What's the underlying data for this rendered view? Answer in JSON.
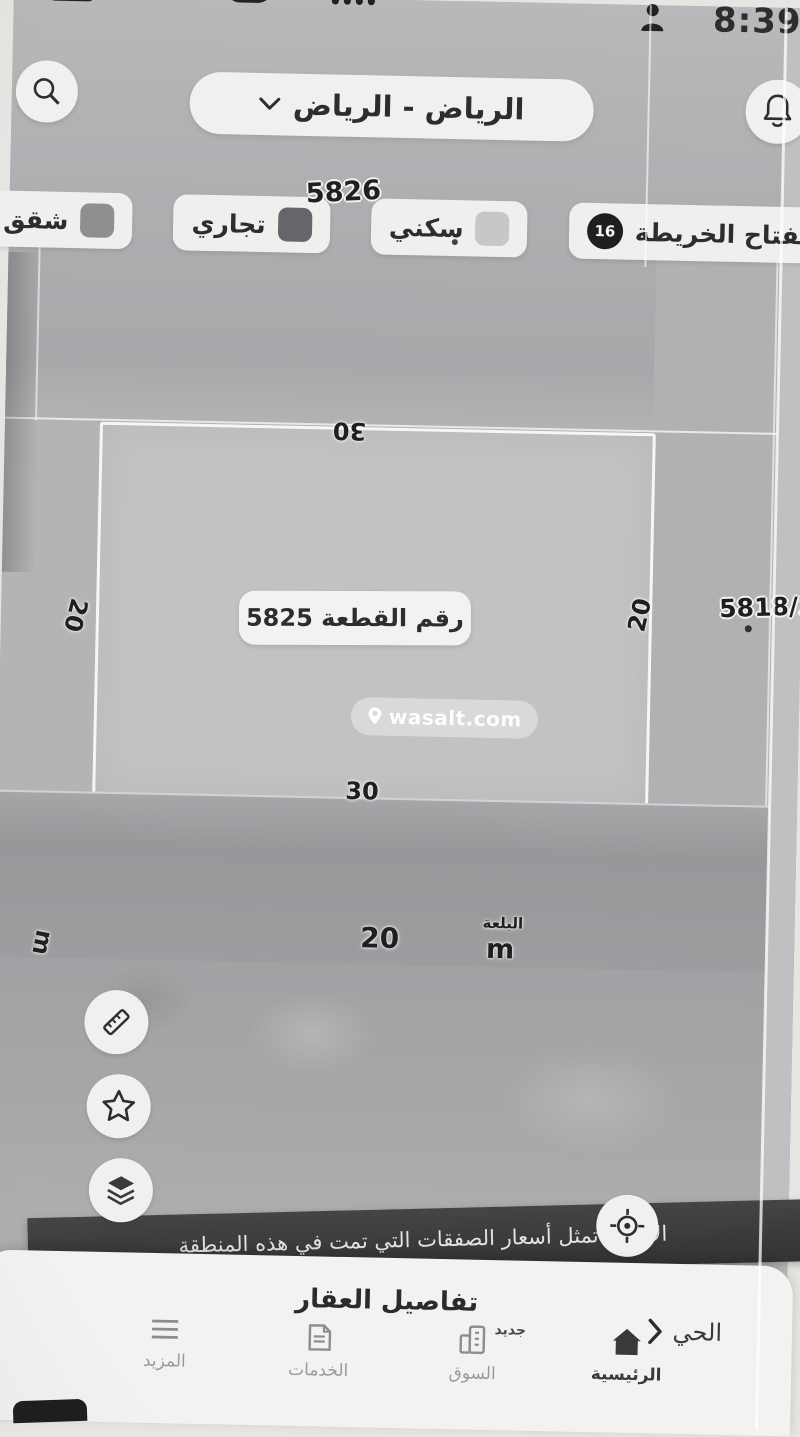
{
  "status_bar": {
    "time": "8:39"
  },
  "header": {
    "location": "الرياض - الرياض"
  },
  "filters": {
    "map_key_label": "مفتاح الخريطة",
    "map_key_badge": "16",
    "chips": [
      {
        "label": "سكني",
        "swatch": "#c7c7c8"
      },
      {
        "label": "تجاري",
        "swatch": "#66666a"
      },
      {
        "label": "شقق",
        "swatch": "#8f8f92"
      }
    ]
  },
  "map": {
    "block_label": "5826",
    "adjacent_parcel_label": "5818/2",
    "parcel": {
      "title": "رقم القطعة 5825",
      "dim_top": "30",
      "dim_bottom": "30",
      "dim_left": "20",
      "dim_right": "20"
    },
    "street": {
      "width": "20",
      "name": "البلعة",
      "unit": "m",
      "left_unit": "m"
    },
    "watermark": "wasalt.com",
    "notice": "الأسعار تمثل أسعار الصفقات التي تمت في هذه المنطقة"
  },
  "sheet": {
    "title": "تفاصيل العقار",
    "district_link": "الحي"
  },
  "bottom_nav": {
    "items": [
      {
        "label": "الرئيسية",
        "icon": "home-icon",
        "active": true
      },
      {
        "label": "السوق",
        "icon": "market-icon",
        "badge": "جديد"
      },
      {
        "label": "الخدمات",
        "icon": "services-document-icon"
      },
      {
        "label": "المزيد",
        "icon": "more-menu-icon"
      }
    ]
  },
  "colors": {
    "map_base": "#b4b4b6",
    "parcel_fill": "#c2c2c4",
    "road": "#9d9da0",
    "pill_bg": "#f1f0ee",
    "ink": "#2d2d2d",
    "notice_band": "#3a3a3a",
    "sheet_bg": "#f3f2f0",
    "badge_bg": "#1f1f1f"
  }
}
